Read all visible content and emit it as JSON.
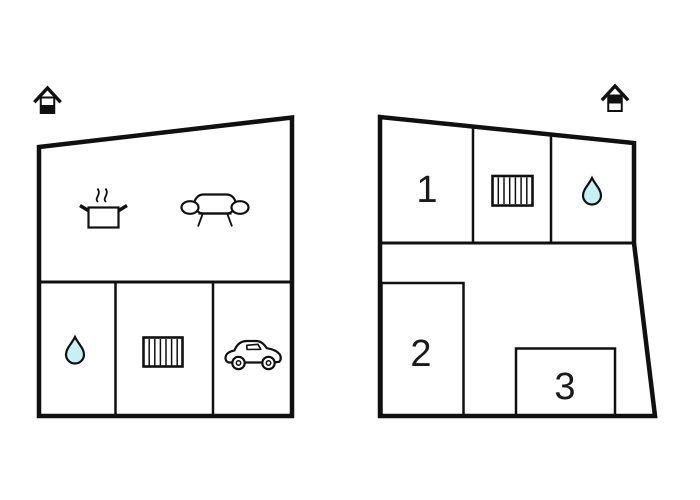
{
  "diagram": {
    "type": "floor-plan",
    "background": "#ffffff",
    "line_color": "#101010",
    "water_drop_color": "#c5f1f4",
    "floors": [
      {
        "id": "left-plan",
        "level_marker": "house-ground-floor-icon",
        "features": [
          "cooking-pot-icon",
          "sofa-icon",
          "water-drop-icon",
          "radiator-icon",
          "car-icon"
        ],
        "room_labels": {}
      },
      {
        "id": "right-plan",
        "level_marker": "house-upper-floor-icon",
        "features": [
          "radiator-icon",
          "water-drop-icon"
        ],
        "room_labels": {
          "room1": "1",
          "room2": "2",
          "room3": "3"
        }
      }
    ]
  }
}
